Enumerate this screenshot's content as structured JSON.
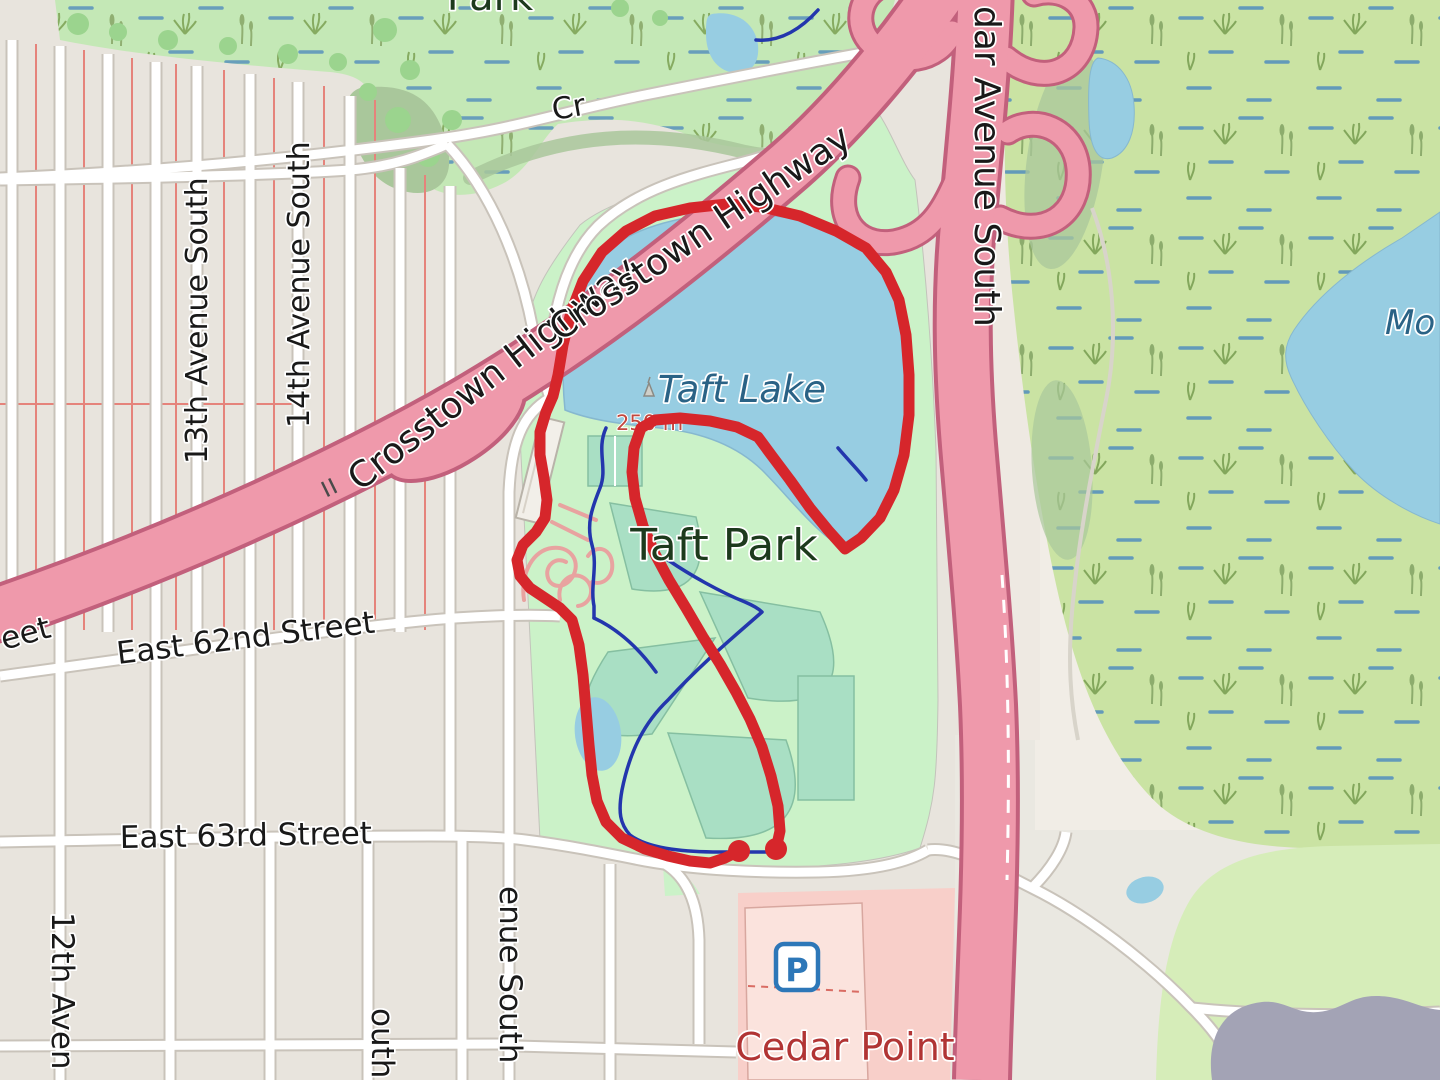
{
  "map": {
    "type": "street-map-with-gps-route",
    "labels": {
      "top_park_partial": "Park",
      "service_road": "Cr",
      "highway_label_1": "Crosstown Highway",
      "highway_label_2": "Crosstown Highway",
      "cedar_avenue_partial": "dar Avenue South",
      "avenue_13": "13th Avenue South",
      "avenue_14": "14th Avenue South",
      "street_62_partial": "eet",
      "street_62": "East 62nd Street",
      "street_63": "East 63rd Street",
      "avenue_12_partial": "12th Aven",
      "avenue_partial_outh": "outh",
      "avenue_partial_enue": "enue South",
      "lake": "Taft Lake",
      "park": "Taft Park",
      "retail_area": "Cedar Point",
      "east_lake_partial": "Mo",
      "distance_marker": "250 m",
      "parking_icon_letter": "P"
    },
    "colors": {
      "route": "#d6262b",
      "water": "#97cde2",
      "park_green": "#cbf2c8",
      "wetland_green": "#cae3a3",
      "pitch_teal": "#a9dfc4",
      "highway_pink": "#ef99ab",
      "highway_casing": "#c2607c",
      "residential_block": "#e8e4dd",
      "road_white": "#ffffff",
      "road_casing": "#c9c3ba",
      "stream_blue": "#2336ad",
      "retail_pink": "#f8cfc9",
      "structure_gray": "#a3a3b5",
      "woodland": "#a9c79b",
      "parking_blue": "#2d77b8"
    },
    "route": {
      "color": "#d6262b",
      "width": 11,
      "dot_radius": 11,
      "start_dot": [
        739,
        851
      ],
      "end_dot": [
        776,
        849
      ],
      "track": [
        [
          739,
          851
        ],
        [
          725,
          858
        ],
        [
          710,
          863
        ],
        [
          690,
          861
        ],
        [
          668,
          856
        ],
        [
          645,
          849
        ],
        [
          622,
          838
        ],
        [
          606,
          822
        ],
        [
          597,
          801
        ],
        [
          592,
          775
        ],
        [
          589,
          745
        ],
        [
          586,
          710
        ],
        [
          583,
          675
        ],
        [
          579,
          645
        ],
        [
          572,
          620
        ],
        [
          560,
          608
        ],
        [
          545,
          598
        ],
        [
          530,
          588
        ],
        [
          520,
          576
        ],
        [
          517,
          560
        ],
        [
          523,
          545
        ],
        [
          536,
          532
        ],
        [
          545,
          518
        ],
        [
          547,
          500
        ],
        [
          544,
          478
        ],
        [
          540,
          455
        ],
        [
          540,
          432
        ],
        [
          546,
          412
        ],
        [
          553,
          396
        ],
        [
          558,
          375
        ],
        [
          563,
          345
        ],
        [
          571,
          312
        ],
        [
          583,
          281
        ],
        [
          602,
          252
        ],
        [
          626,
          231
        ],
        [
          655,
          216
        ],
        [
          690,
          208
        ],
        [
          727,
          204
        ],
        [
          762,
          207
        ],
        [
          800,
          216
        ],
        [
          836,
          231
        ],
        [
          866,
          248
        ],
        [
          886,
          272
        ],
        [
          899,
          300
        ],
        [
          906,
          335
        ],
        [
          909,
          375
        ],
        [
          909,
          415
        ],
        [
          904,
          455
        ],
        [
          894,
          490
        ],
        [
          880,
          518
        ],
        [
          861,
          538
        ],
        [
          845,
          549
        ],
        [
          828,
          530
        ],
        [
          810,
          508
        ],
        [
          790,
          480
        ],
        [
          772,
          456
        ],
        [
          758,
          437
        ],
        [
          737,
          427
        ],
        [
          710,
          421
        ],
        [
          680,
          418
        ],
        [
          655,
          420
        ],
        [
          641,
          428
        ],
        [
          634,
          448
        ],
        [
          632,
          472
        ],
        [
          635,
          498
        ],
        [
          643,
          526
        ],
        [
          655,
          554
        ],
        [
          669,
          580
        ],
        [
          686,
          608
        ],
        [
          703,
          637
        ],
        [
          720,
          664
        ],
        [
          736,
          692
        ],
        [
          750,
          719
        ],
        [
          762,
          747
        ],
        [
          771,
          776
        ],
        [
          778,
          806
        ],
        [
          780,
          831
        ],
        [
          776,
          849
        ]
      ]
    }
  }
}
